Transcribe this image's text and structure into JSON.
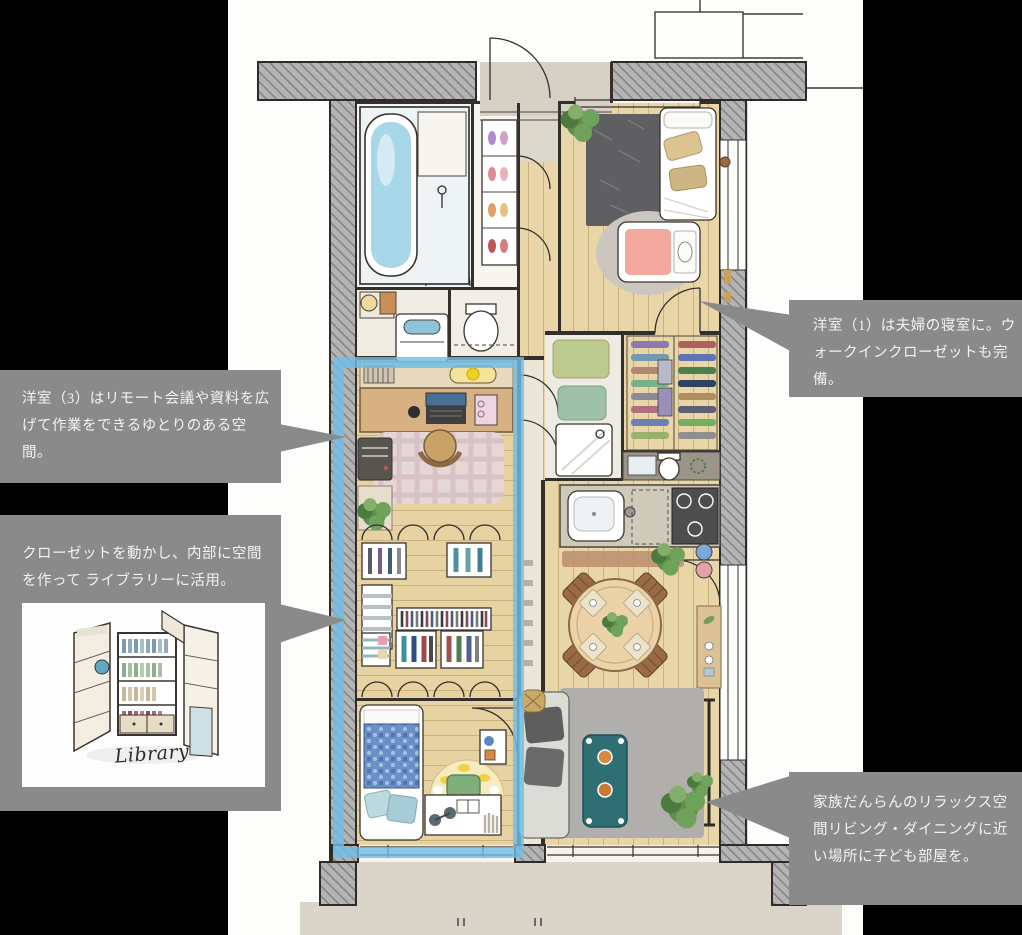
{
  "colors": {
    "bg": "#000000",
    "callout_bg": "#8a8a8a",
    "callout_text": "#f4f3f1",
    "highlight": "#6fbde6"
  },
  "callouts": {
    "bedroom": {
      "text": "洋室（1）は夫婦の寝室に。ウォークインクローゼットも完備。"
    },
    "office": {
      "text": "洋室（3）はリモート会議や資料を広げて作業をできるゆとりのある空間。"
    },
    "library": {
      "text": "クローゼットを動かし、内部に空間を作って ライブラリーに活用。",
      "image_caption": "Library"
    },
    "living": {
      "text": "家族だんらんのリラックス空間リビング・ダイニングに近い場所に子ども部屋を。"
    }
  }
}
